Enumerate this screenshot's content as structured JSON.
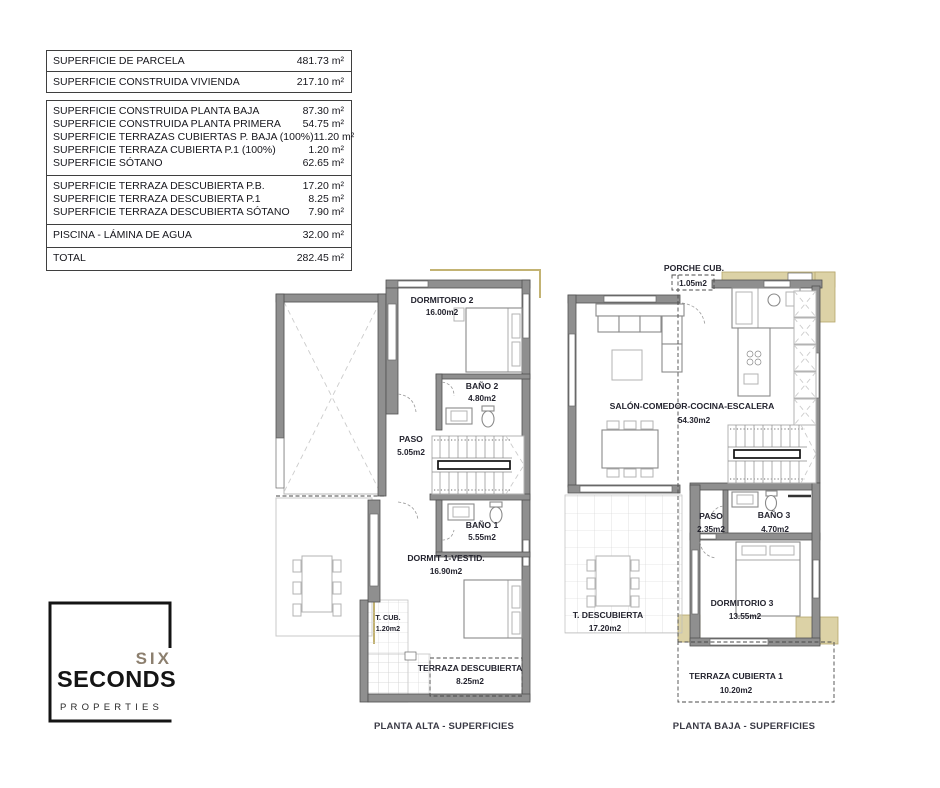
{
  "area_table": {
    "top": {
      "rows": [
        {
          "label": "SUPERFICIE DE PARCELA",
          "value": "481.73 m²"
        },
        {
          "label": "SUPERFICIE CONSTRUIDA VIVIENDA",
          "value": "217.10 m²"
        }
      ]
    },
    "main": {
      "groups": [
        {
          "rows": [
            {
              "label": "SUPERFICIE CONSTRUIDA PLANTA BAJA",
              "value": "87.30 m²"
            },
            {
              "label": "SUPERFICIE CONSTRUIDA PLANTA PRIMERA",
              "value": "54.75 m²"
            },
            {
              "label": "SUPERFICIE TERRAZAS CUBIERTAS P. BAJA (100%)",
              "value": "11.20 m²"
            },
            {
              "label": "SUPERFICIE TERRAZA CUBIERTA P.1 (100%)",
              "value": "1.20 m²"
            },
            {
              "label": "SUPERFICIE SÓTANO",
              "value": "62.65 m²"
            }
          ]
        },
        {
          "rows": [
            {
              "label": "SUPERFICIE TERRAZA DESCUBIERTA P.B.",
              "value": "17.20 m²"
            },
            {
              "label": "SUPERFICIE TERRAZA DESCUBIERTA P.1",
              "value": "8.25 m²"
            },
            {
              "label": "SUPERFICIE TERRAZA DESCUBIERTA SÓTANO",
              "value": "7.90 m²"
            }
          ]
        },
        {
          "rows": [
            {
              "label": "PISCINA - LÁMINA DE AGUA",
              "value": "32.00 m²"
            }
          ]
        },
        {
          "rows": [
            {
              "label": "TOTAL",
              "value": "282.45 m²"
            }
          ]
        }
      ]
    }
  },
  "plans": {
    "alta": {
      "caption": "PLANTA ALTA - SUPERFICIES",
      "rooms": {
        "dormitorio2": {
          "name": "DORMITORIO 2",
          "area": "16.00m2"
        },
        "bano2": {
          "name": "BAÑO 2",
          "area": "4.80m2"
        },
        "paso": {
          "name": "PASO",
          "area": "5.05m2"
        },
        "bano1": {
          "name": "BAÑO 1",
          "area": "5.55m2"
        },
        "dormit1": {
          "name": "DORMIT 1-VESTID.",
          "area": "16.90m2"
        },
        "tcub": {
          "name": "T. CUB.",
          "area": "1.20m2"
        },
        "terraza_descubierta": {
          "name": "TERRAZA DESCUBIERTA",
          "area": "8.25m2"
        }
      }
    },
    "baja": {
      "caption": "PLANTA BAJA - SUPERFICIES",
      "rooms": {
        "porche": {
          "name": "PORCHE CUB.",
          "area": "1.05m2"
        },
        "salon": {
          "name": "SALÓN-COMEDOR-COCINA-ESCALERA",
          "area": "54.30m2"
        },
        "paso": {
          "name": "PASO",
          "area": "2.35m2"
        },
        "bano3": {
          "name": "BAÑO 3",
          "area": "4.70m2"
        },
        "dormitorio3": {
          "name": "DORMITORIO 3",
          "area": "13.55m2"
        },
        "t_descubierta": {
          "name": "T. DESCUBIERTA",
          "area": "17.20m2"
        },
        "terraza_cubierta1": {
          "name": "TERRAZA CUBIERTA 1",
          "area": "10.20m2"
        }
      }
    }
  },
  "logo": {
    "line1": "SIX",
    "line2": "SECONDS",
    "line3": "PROPERTIES"
  },
  "colors": {
    "wall_gray": "#8f8f8f",
    "terrace_beige": "#dcd2a6",
    "logo_taupe": "#8c7f6e",
    "text_dark": "#16161c"
  }
}
